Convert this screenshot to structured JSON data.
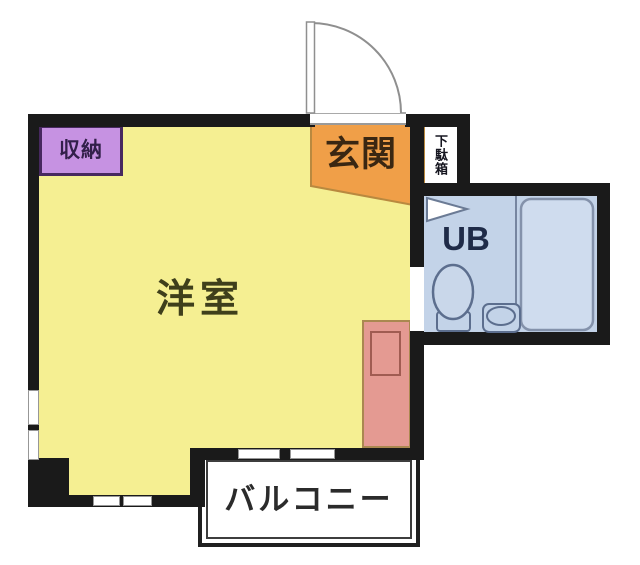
{
  "rooms": {
    "living": {
      "label": "洋室"
    },
    "entrance": {
      "label": "玄関"
    },
    "storage": {
      "label": "収納"
    },
    "shoe_cabinet": {
      "label": "下駄箱"
    },
    "unit_bath": {
      "label": "UB"
    },
    "balcony": {
      "label": "バルコニー"
    }
  },
  "colors": {
    "wall": "#1a1a1a",
    "living_fill": "#f5ef92",
    "entrance_fill": "#f09f48",
    "entrance_border": "#b9893f",
    "storage_fill": "#c692e2",
    "storage_border": "#47285f",
    "unit_bath_fill": "#c3d3e8",
    "bathtub_fill": "#cfdcee",
    "fixture_stroke": "#5c6e8e",
    "kitchen_fill": "#e49a92",
    "kitchen_border": "#aa8850",
    "balcony_fill": "#ffffff"
  }
}
